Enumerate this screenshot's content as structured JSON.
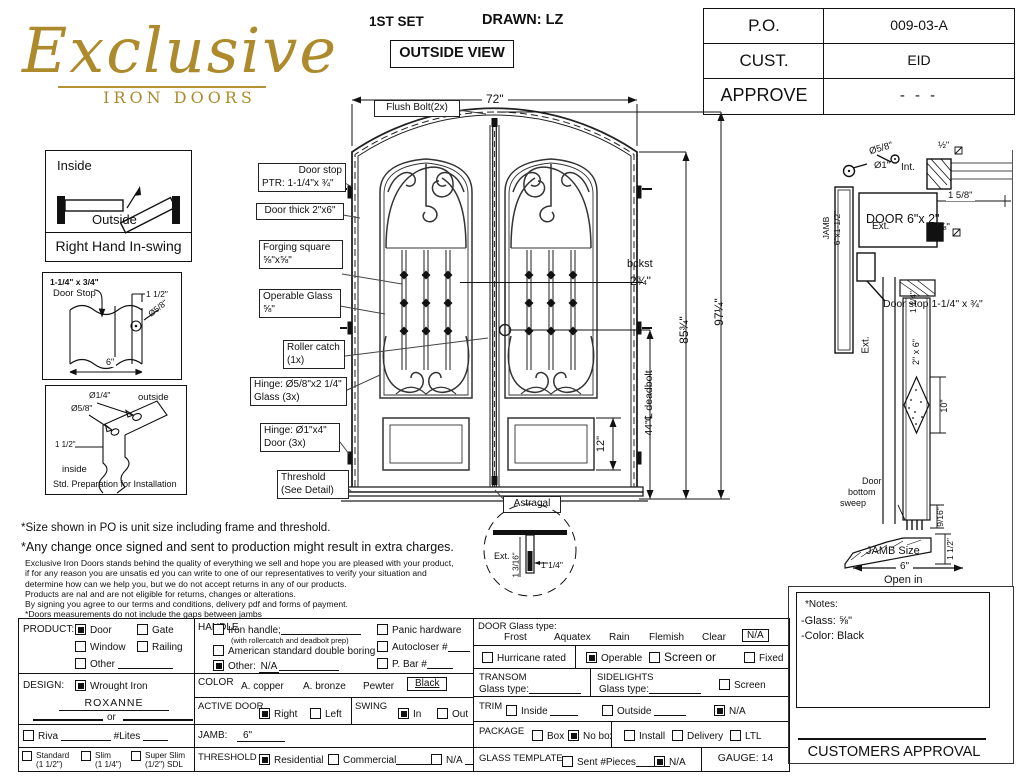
{
  "header": {
    "logo_title": "Exclusive",
    "logo_subtitle": "IRON DOORS",
    "set": "1ST SET",
    "drawn": "DRAWN: LZ",
    "view": "OUTSIDE VIEW",
    "table": [
      {
        "label": "P.O.",
        "value": "009-03-A"
      },
      {
        "label": "CUST.",
        "value": "EID"
      },
      {
        "label": "APPROVE",
        "value": "- - -"
      }
    ]
  },
  "swing_box": {
    "inside": "Inside",
    "outside": "Outside",
    "caption": "Right Hand In-swing"
  },
  "doorstop_box": {
    "size": "1-1/4\" x 3/4\"",
    "name": "Door Stop",
    "dim_offset": "1 1/2\"",
    "dim_hole": "Ø5/8\"",
    "dim_width": "6\""
  },
  "prep_box": {
    "hole_small": "Ø1/4\"",
    "outside": "outside",
    "hole_big": "Ø5/8\"",
    "offset": "1 1/2\"",
    "inside": "inside",
    "caption": "Std. Preparation for Installation"
  },
  "drawing": {
    "width": "72\"",
    "flush_bolt": "Flush Bolt(2x)",
    "door_stop_1": "Door stop",
    "door_stop_2": "PTR: 1-1/4\"x ¾\"",
    "door_thick": "Door thick 2\"x6\"",
    "forging_1": "Forging square",
    "forging_2": "⅝\"x⅝\"",
    "operable_1": "Operable Glass",
    "operable_2": "⅝\"",
    "roller_1": "Roller catch",
    "roller_2": "(1x)",
    "hinge_glass_1": "Hinge: Ø5/8\"x2 1/4\"",
    "hinge_glass_2": "Glass (3x)",
    "hinge_door_1": "Hinge: Ø1\"x4\"",
    "hinge_door_2": "Door (3x)",
    "threshold_1": "Threshold",
    "threshold_2": "(See Detail)",
    "astragal": "Astragal",
    "bckst": "bckst",
    "bckst_val": "2¾\"",
    "deadbolt": "44\"℄ deadbolt",
    "height_leaf": "85¾\"",
    "height_unit": "97¼\"",
    "panel": "12\"",
    "ast_ext": "Ext.",
    "ast_dim1": "1 3/16\"",
    "ast_dim2": "1 1/4\""
  },
  "jamb_detail": {
    "hole_small": "Ø5/8\"",
    "half": "½\"",
    "hole_big": "Ø1\"",
    "int": "Int.",
    "door": "DOOR 6\"x 2\"",
    "dim1": "1 5/8\"",
    "ext": "Ext.",
    "five8": "⅝\"",
    "door_stop": "Door stop 1-1/4\" x ¾\"",
    "jamb1": "JAMB",
    "jamb2": "6\"x1-1/2\""
  },
  "section": {
    "dim_top": "1 1/4\"",
    "door": "2\" x 6\"",
    "ext": "Ext.",
    "glass": "10\"",
    "sweep_dim": "9/16\"",
    "sweep1": "Door",
    "sweep2": "bottom",
    "sweep3": "sweep",
    "jamb_size": "JAMB Size",
    "jamb_val": "6\"",
    "open_in": "Open in",
    "dim_bottom": "1 1/2\""
  },
  "notes": {
    "line1": "*Size shown in PO is unit size including frame and threshold.",
    "line2": "*Any change once signed and sent to production might result in extra charges.",
    "small": [
      "Exclusive Iron Doors stands behind the quality of everything we sell and hope you are pleased with your product,",
      "if for any reason you are unsatis ed you can write to one of our representatives to verify your situation and",
      "determine how can we help you, but we do not accept returns in any of our products.",
      "Products are  nal and are not eligible for returns, changes or alterations.",
      "By signing you agree to our terms and conditions, delivery pdf and forms of payment.",
      "*Doors measurements do not include the gaps between jambs"
    ]
  },
  "form": {
    "product": {
      "label": "PRODUCT:",
      "door": "Door",
      "gate": "Gate",
      "window": "Window",
      "railing": "Railing",
      "other": "Other"
    },
    "design": {
      "label": "DESIGN:",
      "wrought": "Wrought Iron",
      "name": "ROXANNE",
      "or": "or",
      "riva": "Riva",
      "lites": "#Lites",
      "standard": "Standard",
      "standard_s": "(1 1/2\")",
      "slim": "Slim",
      "slim_s": "(1 1/4\")",
      "superslim": "Super Slim",
      "superslim_s": "(1/2\") SDL"
    },
    "handle": {
      "label": "HANDLE",
      "iron": "Iron handle;",
      "iron_note": "(with rollercatch and deadbolt prep)",
      "american": "American standard double boring",
      "other": "Other:",
      "other_val": "N/A",
      "panic": "Panic hardware",
      "autocloser": "Autocloser #",
      "pbar": "P. Bar #"
    },
    "color": {
      "label": "COLOR",
      "copper": "A. copper",
      "bronze": "A. bronze",
      "pewter": "Pewter",
      "black": "Black"
    },
    "active": {
      "label": "ACTIVE DOOR",
      "right": "Right",
      "left": "Left"
    },
    "swing": {
      "label": "SWING",
      "sin": "In",
      "sout": "Out"
    },
    "jamb": {
      "label": "JAMB:",
      "value": "6\""
    },
    "threshold": {
      "label": "THRESHOLD",
      "res": "Residential",
      "com": "Commercial",
      "na": "N/A"
    },
    "glass": {
      "label": "DOOR Glass type:",
      "frost": "Frost",
      "aquatex": "Aquatex",
      "rain": "Rain",
      "flemish": "Flemish",
      "clear": "Clear",
      "na": "N/A",
      "hurricane": "Hurricane rated",
      "operable": "Operable",
      "screen": "Screen or",
      "fixed": "Fixed"
    },
    "transom": {
      "label": "TRANSOM",
      "glass_type": "Glass type:"
    },
    "sidelights": {
      "label": "SIDELIGHTS",
      "glass_type": "Glass type:",
      "screen": "Screen"
    },
    "trim": {
      "label": "TRIM",
      "inside": "Inside",
      "outside": "Outside",
      "na": "N/A"
    },
    "pkg": {
      "label": "PACKAGE",
      "box": "Box",
      "nobox": "No box",
      "install": "Install",
      "delivery": "Delivery",
      "ltl": "LTL"
    },
    "tmpl": {
      "label": "GLASS TEMPLATE",
      "sent": "Sent #Pieces",
      "na": "N/A"
    },
    "gauge": "GAUGE: 14"
  },
  "notes_box": {
    "title": "*Notes:",
    "glass": "-Glass: ⅝\"",
    "color": "-Color: Black"
  },
  "approval": "CUSTOMERS APPROVAL",
  "checks": {
    "product_door": true,
    "product_gate": false,
    "product_window": false,
    "product_railing": false,
    "product_other": false,
    "design_wrought": true,
    "riva": false,
    "standard": false,
    "slim": false,
    "superslim": false,
    "handle_iron": false,
    "handle_american": false,
    "handle_other": true,
    "panic": false,
    "autocloser": false,
    "pbar": false,
    "active_right": true,
    "active_left": false,
    "swing_in": true,
    "swing_out": false,
    "threshold_res": true,
    "threshold_com": false,
    "threshold_na": false,
    "hurricane": false,
    "operable": true,
    "screen": false,
    "fixed": false,
    "sidelight_screen": false,
    "trim_inside": false,
    "trim_outside": false,
    "trim_na": true,
    "pkg_box": false,
    "pkg_nobox": true,
    "pkg_install": false,
    "pkg_delivery": false,
    "pkg_ltl": false,
    "tmpl_sent": false,
    "tmpl_na": true
  }
}
